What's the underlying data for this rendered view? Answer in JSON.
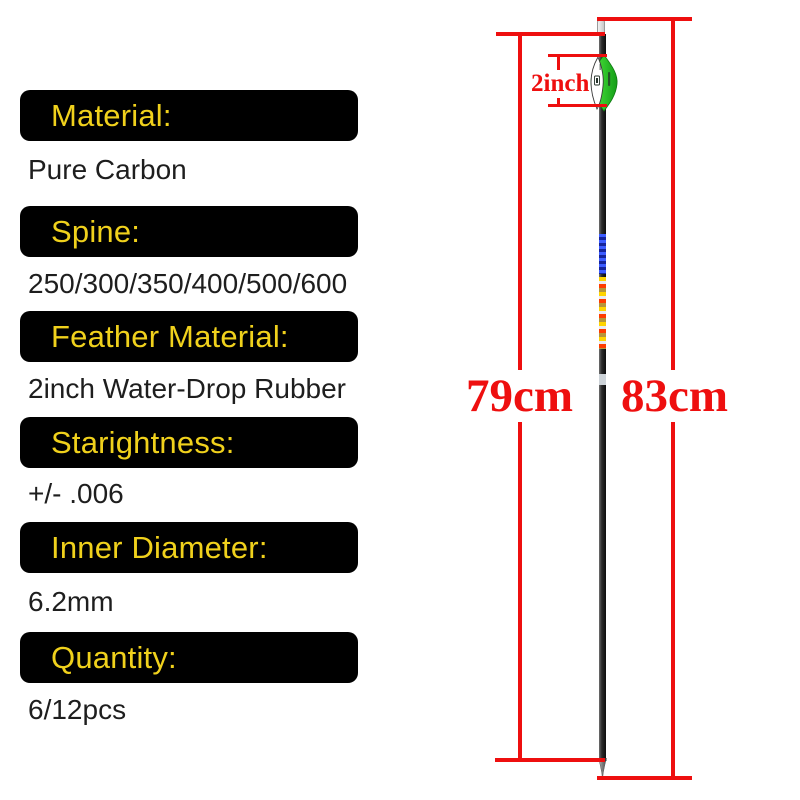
{
  "title": "Archery carbon arrow specification diagram",
  "specs": {
    "box_color": "#000000",
    "label_color": "#f0d11c",
    "items": [
      {
        "label": "Material:",
        "value": "Pure Carbon"
      },
      {
        "label": "Spine:",
        "value": "250/300/350/400/500/600"
      },
      {
        "label": "Feather Material:",
        "value": "2inch Water-Drop Rubber"
      },
      {
        "label": "Starightness:",
        "value": "+/- .006"
      },
      {
        "label": "Inner Diameter:",
        "value": "6.2mm"
      },
      {
        "label": "Quantity:",
        "value": "6/12pcs"
      }
    ]
  },
  "diagram": {
    "dimension_color": "#ee0f0f",
    "fletching_color": "#2fc32a",
    "fletching_length_label": "2inch",
    "shaft_length_label": "79cm",
    "total_length_label": "83cm"
  }
}
